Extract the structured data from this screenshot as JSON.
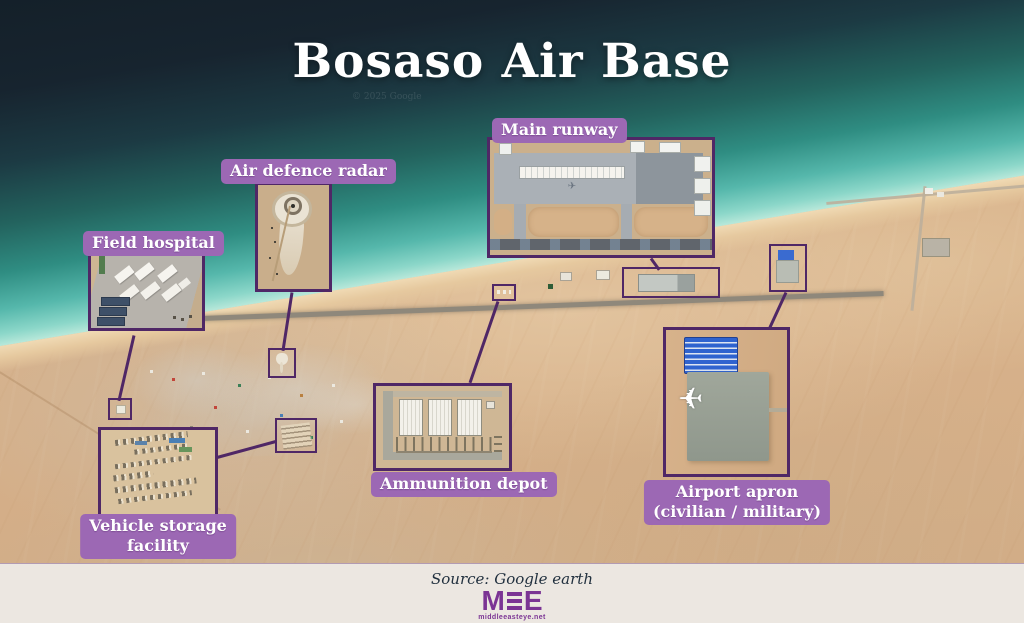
{
  "title": "Bosaso Air Base",
  "watermark": "© 2025 Google",
  "callouts": {
    "main_runway": {
      "label": "Main runway"
    },
    "air_defence_radar": {
      "label": "Air defence radar"
    },
    "field_hospital": {
      "label": "Field hospital"
    },
    "vehicle_storage": {
      "label_line1": "Vehicle storage",
      "label_line2": "facility"
    },
    "ammunition_depot": {
      "label": "Ammunition depot"
    },
    "airport_apron": {
      "label_line1": "Airport apron",
      "label_line2": "(civilian / military)"
    }
  },
  "footer": {
    "source": "Source: Google earth",
    "logo": {
      "m": "M",
      "e": "E",
      "site": "middleeasteye.net"
    }
  },
  "icons": {
    "airplane": "✈"
  },
  "colors": {
    "label_background": "#9c68b4",
    "callout_outline": "#4f2766",
    "logo_purple": "#7b3494",
    "ocean_deep": "#15202b",
    "ocean_teal": "#2e8c83",
    "shore_aqua": "#7fd2c6",
    "sand": "#d8b28c",
    "footer_background": "#ece7e1"
  }
}
